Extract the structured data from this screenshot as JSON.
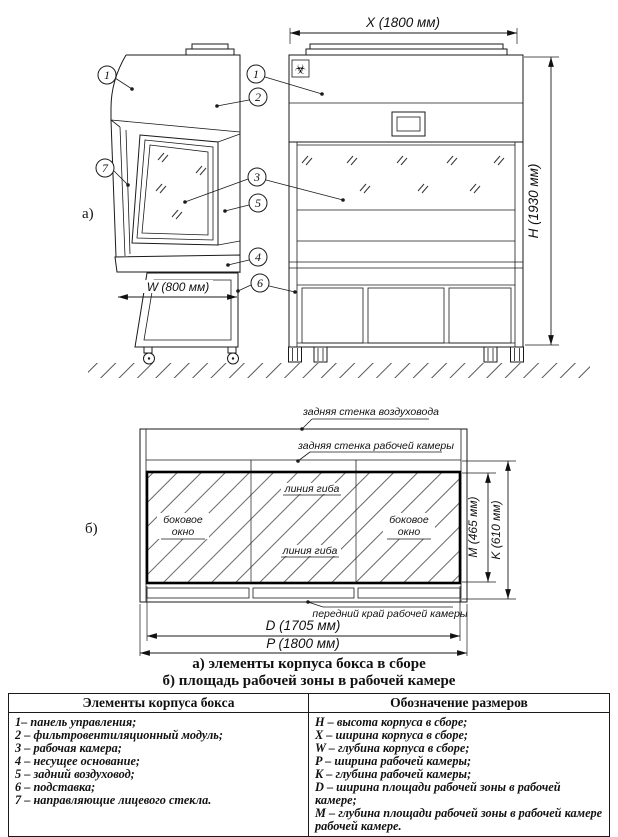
{
  "drawing": {
    "view_a_label": "а)",
    "view_b_label": "б)",
    "biohazard_symbol": "☣",
    "dimensions": {
      "width_overall": "X (1800 мм)",
      "height_overall": "H (1930 мм)",
      "depth_overall": "W (800 мм)",
      "work_zone_width": "D (1705 мм)",
      "chamber_width": "P (1800 мм)",
      "work_zone_depth": "M (465 мм)",
      "chamber_depth": "K (610 мм)"
    },
    "callouts": {
      "c1": "1",
      "c2": "2",
      "c3": "3",
      "c4": "4",
      "c5": "5",
      "c6": "6",
      "c7": "7"
    },
    "plan_labels": {
      "duct_back_wall": "задняя стенка воздуховода",
      "chamber_back_wall": "задняя стенка рабочей камеры",
      "chamber_front_edge": "передний край рабочей камеры",
      "bend_line": "линия гиба",
      "side_window_line1": "боковое",
      "side_window_line2": "окно"
    }
  },
  "captions": {
    "a": "а) элементы корпуса бокса в сборе",
    "b": "б) площадь рабочей зоны в рабочей камере"
  },
  "table": {
    "headers": {
      "elements": "Элементы корпуса бокса",
      "dimensions": "Обозначение размеров"
    },
    "elements": [
      "1– панель управления;",
      "2 – фильтровентиляционный модуль;",
      "3 – рабочая камера;",
      "4 – несущее основание;",
      "5 – задний воздуховод;",
      "6 – подставка;",
      "7 – направляющие лицевого стекла."
    ],
    "dimensions": [
      "H – высота корпуса в сборе;",
      "X – ширина корпуса в сборе;",
      "W – глубина корпуса в сборе;",
      "P – ширина рабочей камеры;",
      "K – глубина рабочей камеры;",
      "D – ширина площади рабочей зоны в рабочей камере;",
      "M – глубина площади рабочей зоны в рабочей камере рабочей камере."
    ]
  }
}
